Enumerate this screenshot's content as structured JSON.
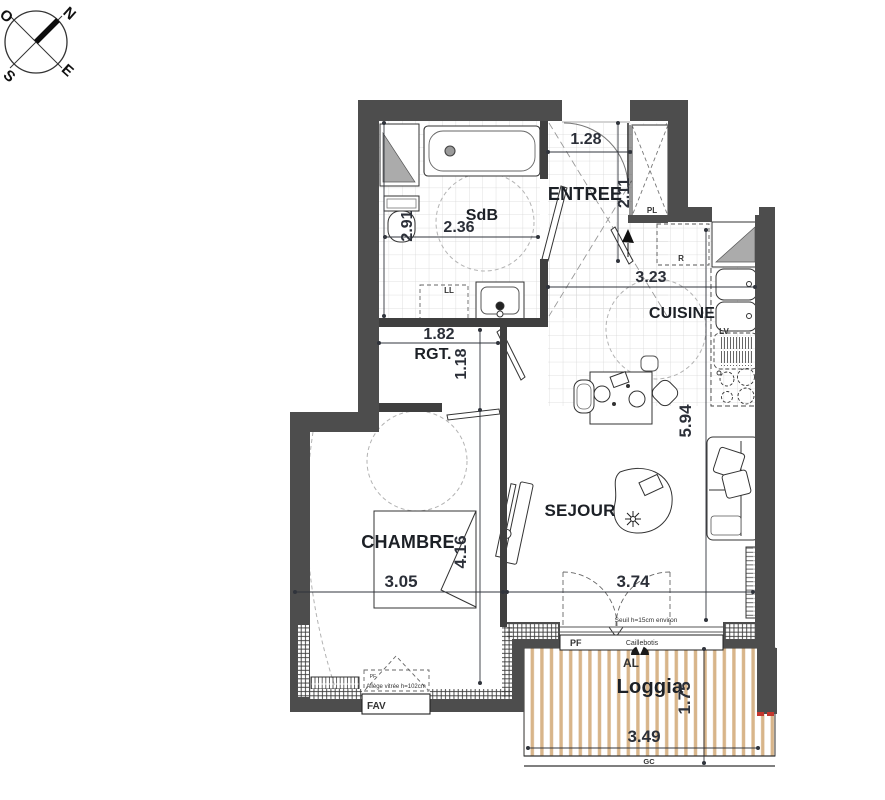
{
  "compass": {
    "north": "N",
    "south": "S",
    "east": "E",
    "west": "O"
  },
  "rooms": {
    "sdb": {
      "label": "SdB",
      "width": "2.36",
      "depth": "2.91"
    },
    "entree": {
      "label": "ENTREE",
      "width": "1.28",
      "depth": "2.11"
    },
    "cuisine": {
      "label": "CUISINE",
      "width": "3.23"
    },
    "rgt": {
      "label": "RGT.",
      "width": "1.82",
      "depth": "1.18"
    },
    "sejour": {
      "label": "SEJOUR",
      "width": "3.74",
      "depth": "5.94"
    },
    "chambre": {
      "label": "CHAMBRE",
      "width": "3.05",
      "depth": "4.16"
    },
    "loggia": {
      "label": "Loggia",
      "width": "3.49",
      "depth": "1.75"
    }
  },
  "annotations": {
    "closet": "PL",
    "fridge": "R",
    "washer": "LL",
    "dishwasher": "LV",
    "window_door": "PF",
    "window_small": "PF",
    "air_vent": "AL",
    "railing": "GC",
    "window_fav": "FAV",
    "decking": "Caillebotis",
    "threshold_note": "Seuil h=15cm environ",
    "sill_note": "Allège vitrée h=102cm"
  },
  "colors": {
    "wall": "#4d4d4d",
    "partition": "#3f3f3f",
    "deck_slat": "#d8b58a",
    "accent_red": "#c3372e",
    "dim_text": "#2b2f38",
    "room_text": "#1c2026"
  }
}
